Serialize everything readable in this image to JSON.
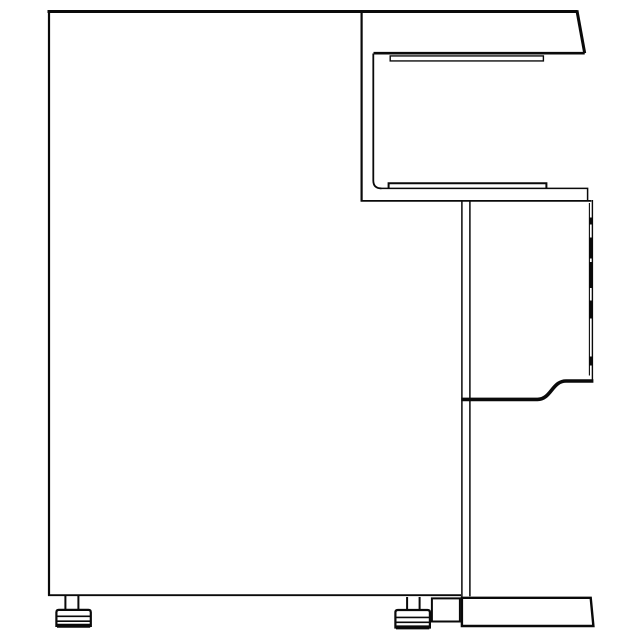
{
  "canvas": {
    "width": 640,
    "height": 640,
    "background_color": "#ffffff",
    "line_color": "#0a0a0a",
    "description": "Technical side-profile line drawing of a cabinet desk unit with counter overhang, knee-space channel, door front, plinth base and adjustable leveling feet"
  },
  "drawing": {
    "paths": [
      {
        "name": "top-edge",
        "d": "M 47.5,11.5 H 577.3",
        "w": 3
      },
      {
        "name": "counter-right-slant-edge",
        "d": "M 576.9,10.3 L 584.7,53.2",
        "w": 3
      },
      {
        "name": "counter-bottom-edge",
        "d": "M 584.7,53.2 H 373.5",
        "w": 2.6
      },
      {
        "name": "panel-left-edge",
        "d": "M 49,10.2 V 595.8",
        "w": 2.2
      },
      {
        "name": "panel-bottom-edge",
        "d": "M 48,595.2 H 461",
        "w": 1.8
      },
      {
        "name": "hutch-upright-outer-edge",
        "d": "M 361.6,10.5 V 201.5",
        "w": 2.2
      },
      {
        "name": "hutch-upright-inner-edge",
        "d": "M 373.3,53.5 V 180.5 Q 373.3,188.4 381.5,188.4",
        "w": 1.8
      },
      {
        "name": "desk-arm-inner-edge",
        "d": "M 380,188.4 H 587.6 V 200.3",
        "w": 1.5
      },
      {
        "name": "desk-arm-outer-edge",
        "d": "M 360.6,200.9 H 591.4",
        "w": 1.8
      },
      {
        "name": "under-counter-strip",
        "d": "M 390.2,55.9 H 543.4 V 60.9 H 390.2 Z",
        "w": 1.4
      },
      {
        "name": "arm-shelf-strip",
        "d": "M 388.6,188.3 V 183.2 H 546.4 V 188.3",
        "w": 2
      },
      {
        "name": "cabinet-back-edge-outer",
        "d": "M 461.9,201 V 598.5",
        "w": 1.5
      },
      {
        "name": "cabinet-back-edge-inner",
        "d": "M 469.9,201 V 596.3",
        "w": 1.5
      },
      {
        "name": "door-right-edge-outer",
        "d": "M 592.4,200 V 379.8",
        "w": 1.4
      },
      {
        "name": "door-right-edge-inner",
        "d": "M 589.4,203 V 375.5",
        "w": 1.1
      },
      {
        "name": "door-gap-marks",
        "d": "M 590.9,217.5 V 224.5 M 590.9,237.5 V 258.5 M 590.9,262 V 288 M 590.9,300.5 V 318.5 M 590.9,356.5 V 365.5",
        "w": 3.4
      },
      {
        "name": "door-bottom-curve",
        "d": "M 461.3,399.4 H 537.5 C 551,399.4 552,381 566,381 H 593.4",
        "w": 3.6
      },
      {
        "name": "plinth-base-outline",
        "d": "M 461.9,597.8 H 590.7 L 593.4,626 H 461.9 Z",
        "w": 2.4
      },
      {
        "name": "plinth-connector-outline",
        "d": "M 431.9,598.4 H 459.9 V 621.5 H 431.9 Z",
        "w": 2
      },
      {
        "name": "left-foot-stem",
        "d": "M 65.4,595.5 V 610 M 78.4,595.5 V 610",
        "w": 2
      },
      {
        "name": "left-foot-pad-outline",
        "d": "M 56.4,627 V 612.3 Q 56.4,609.9 58.8,609.9 H 88.4 Q 90.8,609.9 90.8,612.3 V 627",
        "w": 2.2
      },
      {
        "name": "left-foot-pad-lines",
        "d": "M 56.4,616.3 H 90.8 M 56.4,621.2 H 90.8",
        "w": 1.6
      },
      {
        "name": "left-foot-pad-bottom",
        "d": "M 57,625.8 H 90.2",
        "w": 4
      },
      {
        "name": "right-foot-stem",
        "d": "M 407.1,597 V 610.2 M 419.6,597 V 610.2",
        "w": 2
      },
      {
        "name": "right-foot-pad-outline",
        "d": "M 395.4,628.6 V 612.4 Q 395.4,610 397.8,610 H 427.5 Q 429.9,610 429.9,612.4 V 628.6",
        "w": 2.2
      },
      {
        "name": "right-foot-pad-lines",
        "d": "M 395.4,617.4 H 429.9 M 395.4,622.3 H 429.9",
        "w": 1.6
      },
      {
        "name": "right-foot-pad-bottom",
        "d": "M 396,627.4 H 429.3",
        "w": 4
      }
    ]
  }
}
